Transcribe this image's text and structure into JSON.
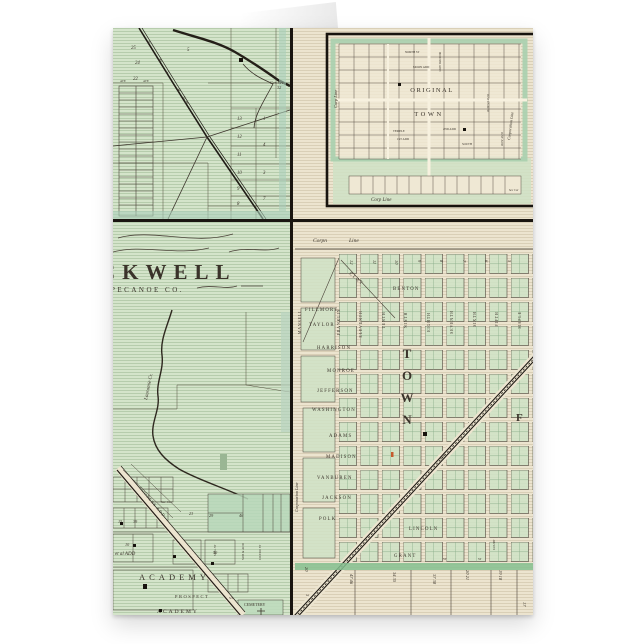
{
  "product": {
    "type": "folded greeting card with vintage plat maps"
  },
  "nw": {
    "rail_label": "E. & L. R.W.",
    "cen_line1": "Cen Sec",
    "cen_line2": "32",
    "ave": "AVE",
    "nums": [
      "25",
      "24",
      "22",
      "5",
      "6",
      "13",
      "12",
      "11",
      "10",
      "9",
      "8",
      "1",
      "4",
      "3",
      "7"
    ]
  },
  "ne": {
    "title1": "ORIGINAL",
    "title2": "TOWN",
    "corp_left": "Corp Line",
    "corp_bottom": "Corp Line",
    "corp_right": "Corporation Line",
    "north_st": "NORTH ST",
    "add_moon": "MOON ADD",
    "add_horner": "HORNER ADD",
    "add_justus": "JUSTUS ADD",
    "add_just2": "JUST ADD",
    "add_2nd": "2ND ADD",
    "add_temple": "TEMPLE",
    "add_1st": "1ST ADD",
    "south": "SOUTH",
    "sec_cor": "Sec Cor"
  },
  "sw": {
    "title": "CKWELL",
    "subtitle": "PECANOE CO.",
    "creek": "Lauramie Cr.",
    "coopers": "COOPERS ADD",
    "et_al": "et al ADD",
    "academy1": "ACADEMY",
    "academy2": "ACADEMY",
    "prospect": "PROSPECT",
    "st": "ST",
    "cemetery": "CEMETERY",
    "sec_cor": "Sec Cor",
    "mill": "MILL ST",
    "sub_add": "SUB & ADD",
    "cicero": "CICERO ST",
    "lots": [
      "23",
      "29",
      "46",
      "50",
      "10",
      "15",
      "39"
    ]
  },
  "se": {
    "corp_top1": "Corpn",
    "corp_top2": "Line",
    "corp_left": "Corporation Line",
    "h_streets": [
      "CLAY",
      "BENTON",
      "FILLMORE",
      "TAYLOR",
      "HARRISON",
      "MONROE",
      "JEFFERSON",
      "WASHINGTON",
      "ADAMS",
      "MADISON",
      "VANBUREN",
      "JACKSON",
      "POLK",
      "LINCOLN",
      "GRANT"
    ],
    "v_streets": [
      "MANSELL",
      "FRANKLIN",
      "ELEVENTH",
      "TENTH",
      "NINTH",
      "EIGHTH",
      "SEVENTH",
      "SIXTH",
      "FIFTH",
      "MAPLE"
    ],
    "block_nums": [
      "12",
      "11",
      "10",
      "9",
      "8",
      "7",
      "6",
      "5"
    ],
    "town": [
      "T",
      "O",
      "W",
      "N"
    ],
    "f": "F",
    "court": "COURT",
    "st": "ST",
    "rail": "R.W.",
    "lots": [
      "47 46",
      "34 35",
      "37 38",
      "20 21",
      "19 18",
      "17",
      "20",
      "3"
    ]
  }
}
